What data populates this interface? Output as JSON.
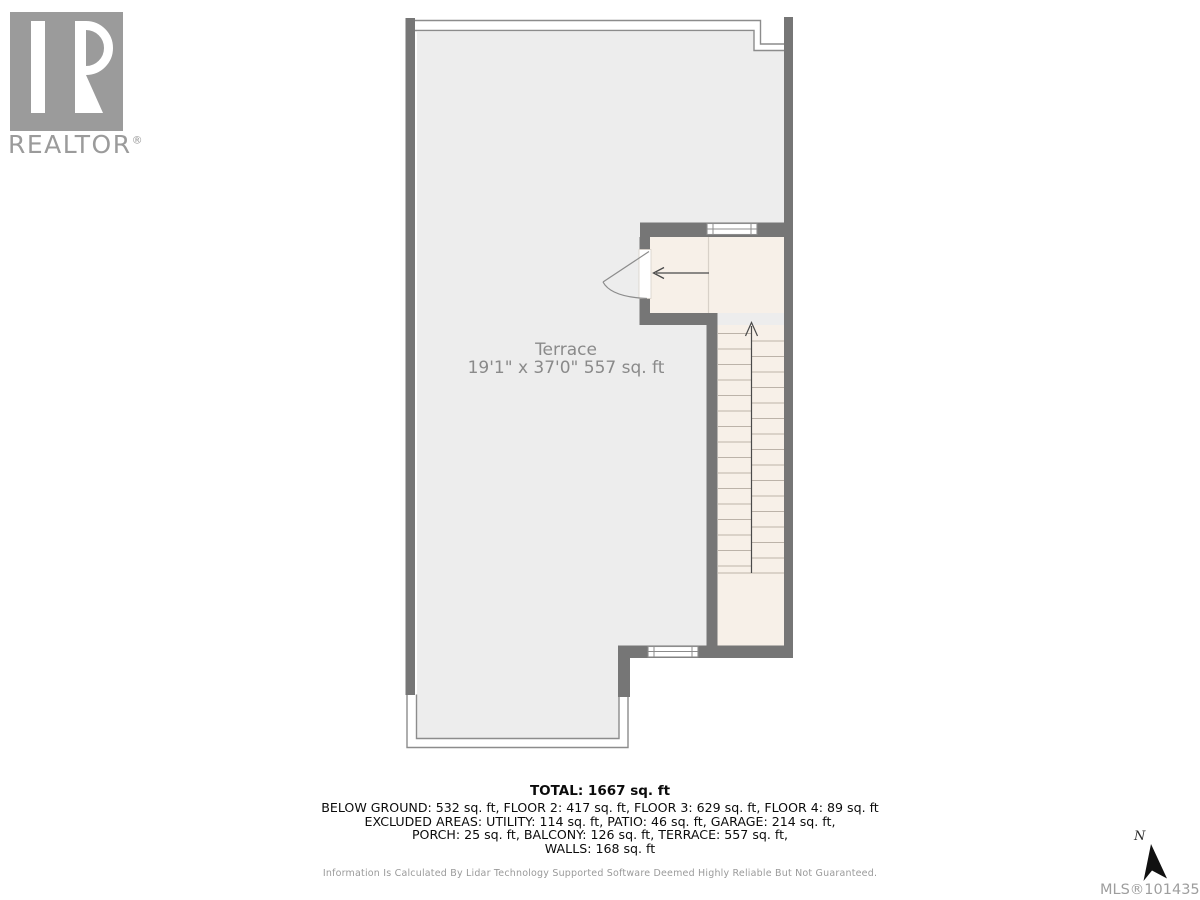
{
  "branding": {
    "logo": "realtor-block-r-logo",
    "wordmark": "REALTOR",
    "registered_mark": "®"
  },
  "floorplan": {
    "room": {
      "name": "Terrace",
      "dims": "19'1\" x 37'0\" 557 sq. ft"
    },
    "symbols": [
      "door-swing",
      "window",
      "stairs-up-arrow",
      "entry-arrow"
    ]
  },
  "summary": {
    "total": "TOTAL: 1667 sq. ft",
    "lines": [
      "BELOW GROUND: 532 sq. ft, FLOOR 2: 417 sq. ft, FLOOR 3: 629 sq. ft, FLOOR 4: 89 sq. ft",
      "EXCLUDED AREAS: UTILITY: 114 sq. ft, PATIO: 46 sq. ft, GARAGE: 214 sq. ft,",
      "PORCH: 25 sq. ft, BALCONY: 126 sq. ft, TERRACE: 557 sq. ft,",
      "WALLS: 168 sq. ft"
    ]
  },
  "disclaimer": "Information Is Calculated By Lidar Technology Supported Software Deemed Highly Reliable But Not Guaranteed.",
  "compass": {
    "north_label": "N"
  },
  "mls": "MLS®1014359",
  "colors": {
    "wall": "#767676",
    "terrace_floor": "#ededed",
    "interior_floor": "#f7f0e8",
    "railing_line": "#8c8c8c",
    "tread_line": "#bcb3a9",
    "label_text": "#8a8a8a",
    "logo_gray": "#9b9b9b",
    "summary_text": "#0b0b0b"
  }
}
